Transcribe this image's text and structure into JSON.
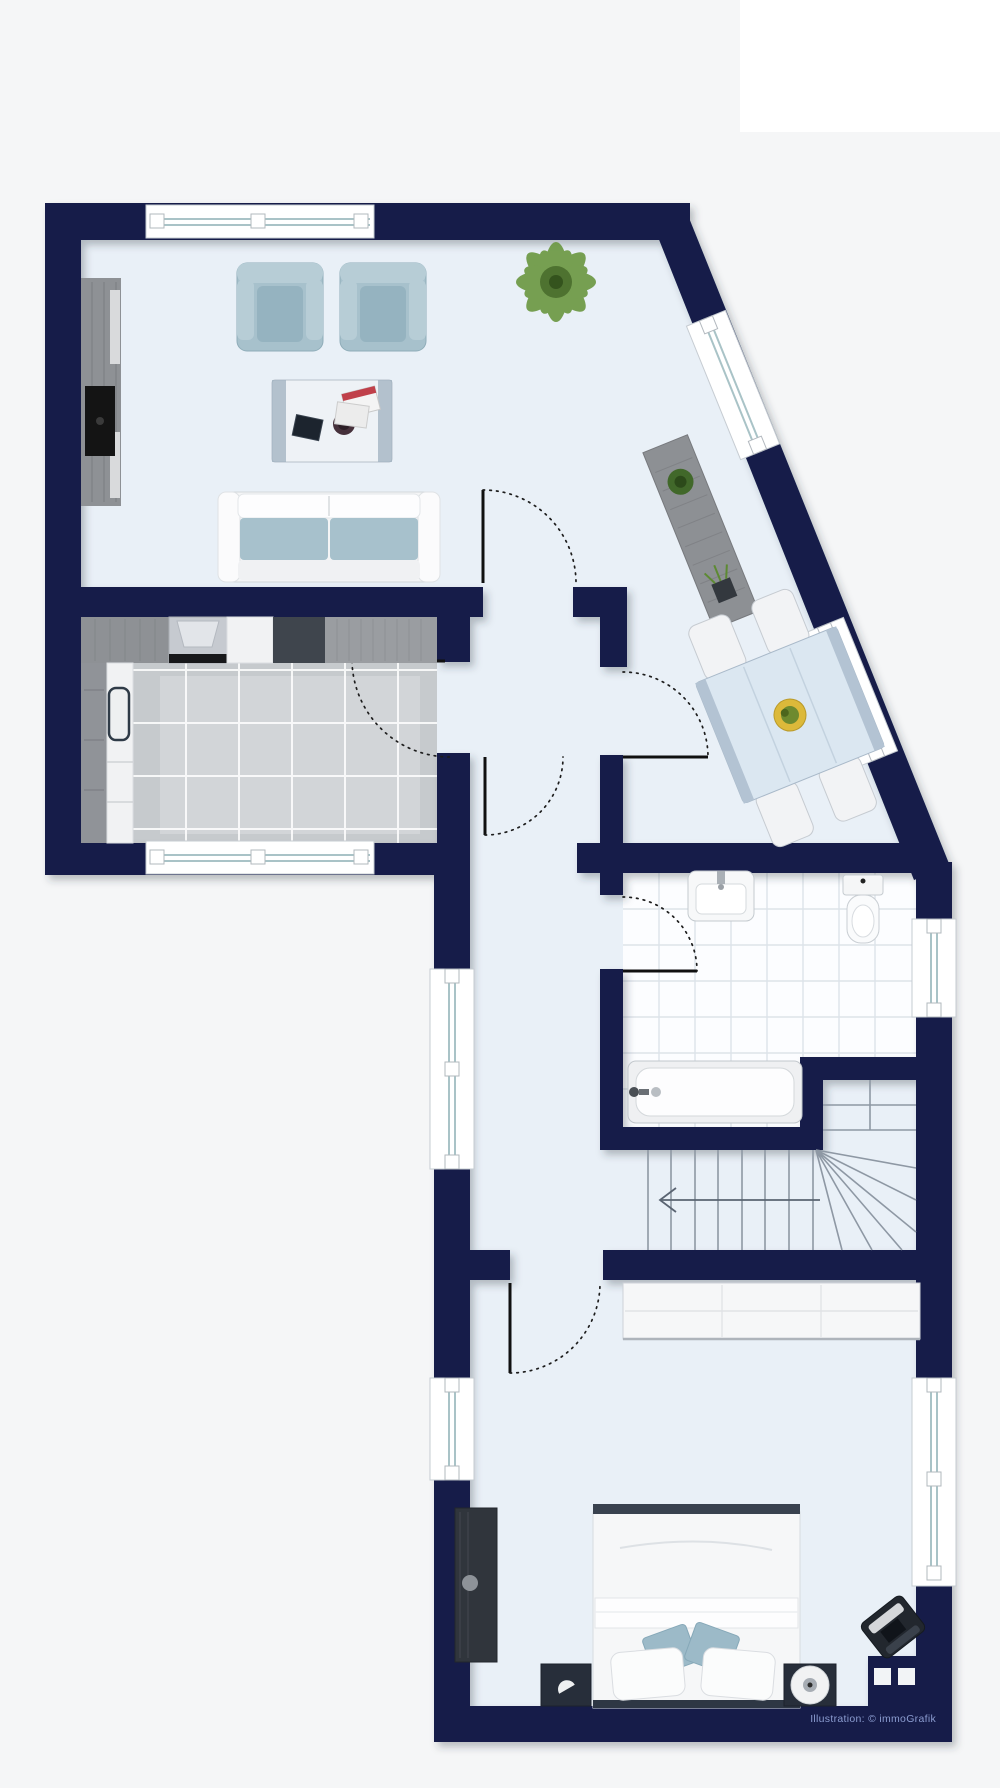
{
  "canvas": {
    "width": 1000,
    "height": 1788
  },
  "watermark": {
    "text": "Illustration: © immoGrafik"
  },
  "palette": {
    "wall": "#131b4a",
    "floor": "#e9f0f7",
    "background": "#f5f6f7",
    "kitchen-tile": "#c6cacd",
    "bath-tile": "#fcfdff",
    "upholstery": "#a7c1cc",
    "furniture-white": "#f5f6f7",
    "wood-gray": "#8e9195",
    "dark-furniture": "#272e3a",
    "stair-line": "#8e98a4",
    "glazing": "#a9c3c7",
    "plant-green": "#6a9740",
    "watermark-color": "#8b9cd0"
  },
  "floor_plan": {
    "type": "apartment-floor-plan",
    "rooms": [
      {
        "name": "living-room",
        "items": [
          "tv-sideboard",
          "armchair",
          "armchair",
          "coffee-table",
          "sofa",
          "potted-plant"
        ]
      },
      {
        "name": "kitchen",
        "items": [
          "counter",
          "stove",
          "cabinet",
          "fridge"
        ]
      },
      {
        "name": "dining-area",
        "items": [
          "dining-table",
          "chair",
          "chair",
          "chair",
          "chair",
          "sideboard"
        ]
      },
      {
        "name": "bathroom",
        "items": [
          "sink",
          "toilet",
          "bathtub"
        ]
      },
      {
        "name": "staircase",
        "items": [
          "winder-stairs",
          "direction-arrow"
        ]
      },
      {
        "name": "bedroom",
        "items": [
          "wardrobe",
          "double-bed",
          "pillow",
          "pillow",
          "nightstand",
          "nightstand",
          "table-lamp",
          "dresser",
          "corner-chair",
          "chimney"
        ]
      }
    ],
    "window_count": 8,
    "door_count": 6
  }
}
